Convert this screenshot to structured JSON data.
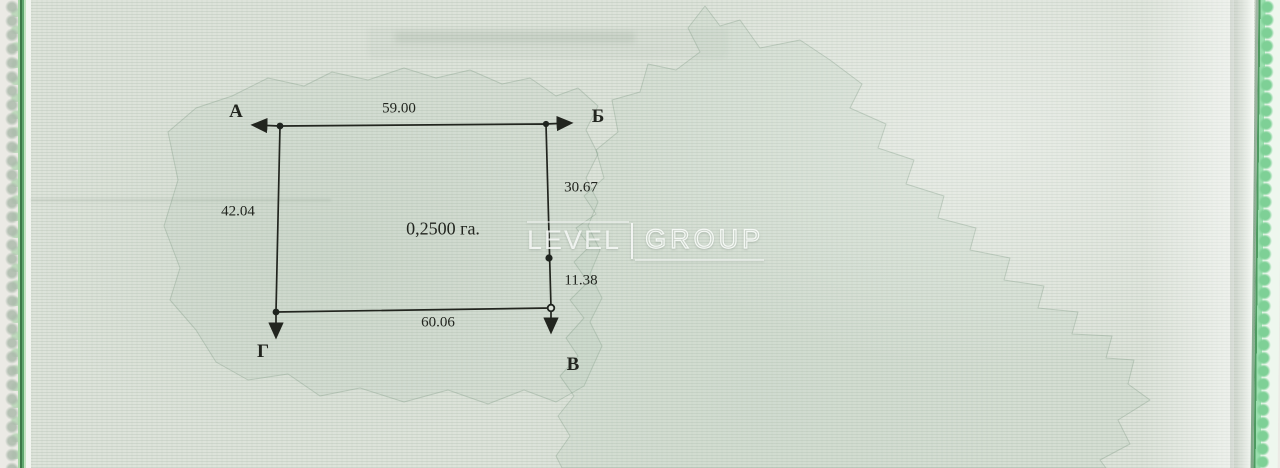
{
  "watermark": {
    "brand_left": "LEVEL",
    "brand_right": "GROUP"
  },
  "diagram": {
    "area_label": "0,2500 га.",
    "corner_labels": {
      "a": "А",
      "b": "Б",
      "v": "В",
      "g": "Г"
    },
    "side_lengths": {
      "top": "59.00",
      "right_upper": "30.67",
      "right_lower": "11.38",
      "bottom": "60.06",
      "left": "42.04"
    }
  },
  "colors": {
    "paper": "#dde3da",
    "pattern_line": "#b9c6b7",
    "ink": "#22251f",
    "edge_green_dark": "#3c7a49",
    "edge_green_light": "#a8d8a8",
    "edge_mint": "#7ed096"
  }
}
